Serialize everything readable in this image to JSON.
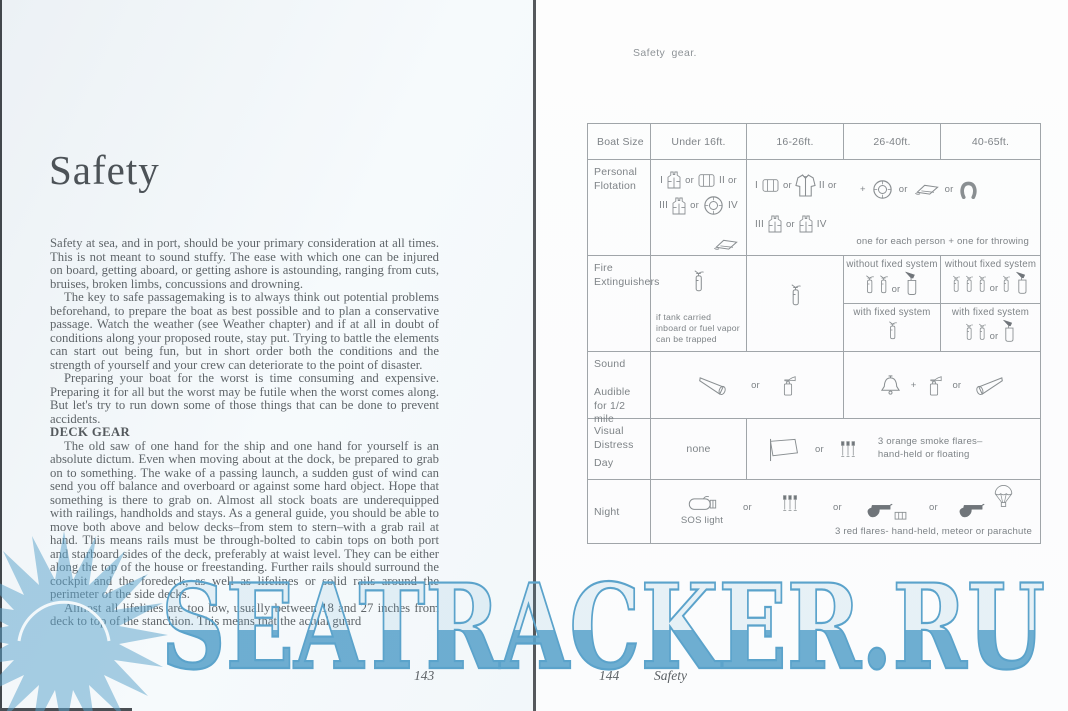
{
  "watermark": {
    "text": "SEATRACKER.RU",
    "color": "#5ba3cb"
  },
  "left_page": {
    "title": "Safety",
    "heading_deck_gear": "DECK GEAR",
    "page_number": "143",
    "paragraphs": {
      "p1": "Safety at sea, and in port, should be your primary consideration at all times. This is not meant to sound stuffy. The ease with which one can be injured on board, getting aboard, or getting ashore is astounding, ranging from cuts, bruises, broken limbs, concussions and drowning.",
      "p2": "The key to safe passagemaking is to always think out potential problems beforehand, to prepare the boat as best possible and to plan a conservative passage. Watch the weather (see Weather chapter) and if at all in doubt of conditions along your proposed route, stay put. Trying to battle the elements can start out being fun, but in short order both the conditions and the strength of yourself and your crew can deteriorate to the point of disaster.",
      "p3": "Preparing your boat for the worst is time consuming and expensive. Preparing it for all but the worst may be futile when the worst comes along. But let's try to run down some of those things that can be done to prevent accidents.",
      "p4": "The old saw of one hand for the ship and one hand for yourself is an absolute dictum. Even when moving about at the dock, be prepared to grab on to something. The wake of a passing launch, a sudden gust of wind can send you off balance and overboard or against some hard object. Hope that something is there to grab on. Almost all stock boats are underequipped with railings, handholds and stays. As a general guide, you should be able to move both above and below decks–from stem to stern–with a grab rail at hand. This means rails must be through-bolted to cabin tops on both port and starboard sides of the deck, preferably at waist level. They can be either along the top of the house or freestanding. Further rails should surround the cockpit and the foredeck, as well as lifelines or solid rails around the perimeter of the side decks.",
      "p5": "Almost all lifelines are too low, usually between 18 and 27 inches from deck to top of the stanchion. This means that the actual guard"
    }
  },
  "right_page": {
    "caption": "Safety gear.",
    "page_number": "144",
    "running_title": "Safety",
    "table": {
      "headers": [
        "Boat Size",
        "Under 16ft.",
        "16-26ft.",
        "26-40ft.",
        "40-65ft."
      ],
      "tokens": {
        "or": "or",
        "plus": "+",
        "n1": "I",
        "n2": "II",
        "n3": "III",
        "n4": "IV"
      },
      "personal_flotation": {
        "label": "Personal Flotation",
        "note": "one for each person + one for throwing"
      },
      "fire_extinguishers": {
        "label": "Fire Extinguishers",
        "under16_note": "if tank carried inboard or fuel vapor can be trapped",
        "without_fixed": "without fixed system",
        "with_fixed": "with fixed system"
      },
      "sound": {
        "label": "Sound",
        "sublabel": "Audible for 1/2 mile"
      },
      "visual_distress": {
        "label": "Visual Distress",
        "day": "Day",
        "under16": "none",
        "note": "3 orange smoke flares– hand-held or floating"
      },
      "night": {
        "label": "Night",
        "sos": "SOS light",
        "note": "3 red flares- hand-held, meteor or parachute"
      }
    }
  }
}
